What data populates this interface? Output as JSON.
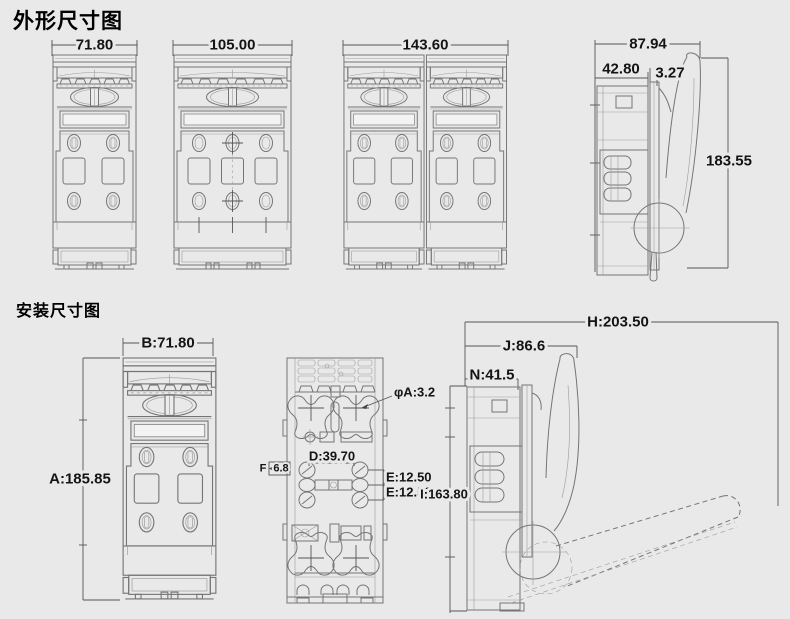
{
  "page": {
    "background": "#e9e9e9",
    "line_color": "#757575",
    "text_color": "#141414"
  },
  "sections": {
    "outline_title": "外形尺寸图",
    "installation_title": "安装尺寸图"
  },
  "outline": {
    "front_narrow": {
      "width": "71.80"
    },
    "front_wide": {
      "width": "105.00"
    },
    "front_double": {
      "width": "143.60"
    },
    "side": {
      "overall_width": "87.94",
      "body_depth": "42.80",
      "plate_thickness": "3.27",
      "overall_height": "183.55"
    }
  },
  "installation": {
    "front": {
      "width": "B:71.80",
      "height": "A:185.85"
    },
    "rear": {
      "mount_hole": "φA:3.2",
      "hole_spacing": "D:39.70",
      "slot_label": "F",
      "slot_width": "6.8",
      "pitch_upper": "E:12.50",
      "pitch_lower": "E:12.50"
    },
    "side": {
      "overall_with_handle": "H:203.50",
      "handle_reach": "J:86.6",
      "body_depth": "N:41.5",
      "mount_height": "I:163.80"
    }
  }
}
